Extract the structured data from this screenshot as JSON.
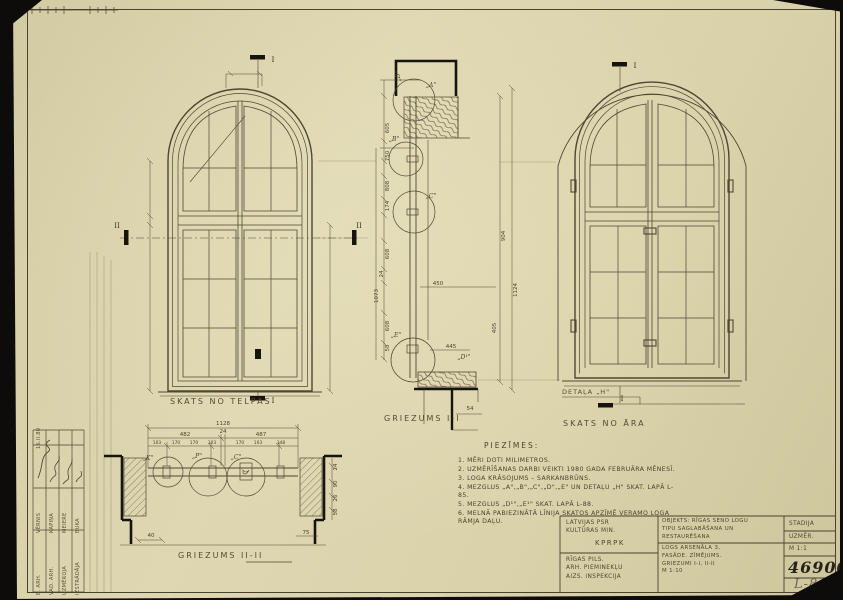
{
  "sheet": {
    "drawing_number": "46900",
    "sheet_code": "L-86",
    "stage_label": "STADIJA",
    "stage_value": "UZMĒR.",
    "scale_value": "M 1:1"
  },
  "captions": {
    "view_inside": "SKATS NO TELPAS",
    "section_i": "GRIEZUMS I-I",
    "view_outside": "SKATS  NO  ĀRA",
    "detail_h": "DETAĻA „H\"",
    "section_ii": "GRIEZUMS II-II"
  },
  "notes": {
    "title": "PIEZĪMES:",
    "items": [
      "1. MĒRI DOTI MILIMETROS.",
      "2. UZMĒRĪŠANAS DARBI VEIKTI 1980 GADA FEBRUĀRA MĒNESĪ.",
      "3. LOGA KRĀSOJUMS – SARKANBRŪNS.",
      "4. MEZGLUS „A\",„B\",„C\",„D\",„E\" UN DETAĻU „H\" SKAT. LAPĀ L-85.",
      "5. MEZGLUS „D¹\",„E¹\" SKAT. LAPĀ L-88.",
      "6. MELNĀ PABIEZINĀTĀ LĪNIJA SKATOS APZĪMĒ VERAMO LOGA RĀMJA DAĻU."
    ]
  },
  "title_block": {
    "org_top": [
      "LATVIJAS PSR",
      "KULTŪRAS MIN.",
      "KPRPK"
    ],
    "org_bottom": [
      "RĪGAS PILS.",
      "ARH. PIEMINEKĻU",
      "AIZS. INSPEKCIJA"
    ],
    "object_lines": [
      "OBJEKTS: RĪGAS SENO LOGU",
      "TIPU SAGLABĀŠANA UN",
      "RESTAURĒŠANA"
    ],
    "subject_lines": [
      "LOGS ARSENĀLA 3,",
      "FASĀDE. ZĪMĒJUMS.",
      "GRIEZUMI I-I, II-II",
      "M 1:10"
    ]
  },
  "signatures": {
    "rows": [
      {
        "role": "B. ARH.",
        "name": "VĒRNIS"
      },
      {
        "role": "VAD. ARH.",
        "name": "KAPIŅA"
      },
      {
        "role": "UZMĒROJA",
        "name": "MEIERE"
      },
      {
        "role": "IZSTRĀDĀJA",
        "name": "BUKA"
      }
    ],
    "date": "16.II.80"
  },
  "markers": {
    "i": "I",
    "ii": "II"
  },
  "details": {
    "a": "„A\"",
    "b": "„B\"",
    "c": "„C\"",
    "d": "„D\"",
    "e": "„E\"",
    "d1": "„D¹\"",
    "k": "„K\"",
    "p": "„P\"",
    "c2": "„C\""
  },
  "dims": {
    "plan_overall": "1128",
    "plan_a": "482",
    "plan_b": "24",
    "plan_c": "487",
    "plan_s1": "103",
    "plan_s2": "170",
    "plan_s3": "170",
    "plan_s4": "103",
    "plan_s5": "170",
    "plan_s6": "103",
    "plan_s7": "148",
    "plan_left": "40",
    "plan_right": "75",
    "plan_r1": "24",
    "plan_r2": "90",
    "plan_r3": "26",
    "plan_r4": "58",
    "sec_605": "605",
    "sec_750": "750",
    "sec_808": "808",
    "sec_174": "174",
    "sec_608a": "608",
    "sec_24": "24",
    "sec_1073": "1073",
    "sec_608b": "608",
    "sec_58": "58",
    "sec_904": "904",
    "sec_1124": "1124",
    "sec_405": "405",
    "sec_450": "450",
    "sec_445": "445",
    "sec_54": "54"
  }
}
